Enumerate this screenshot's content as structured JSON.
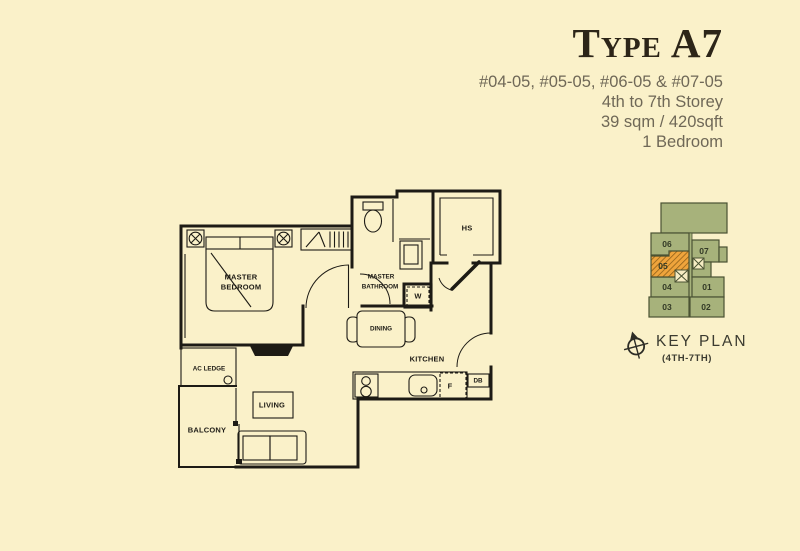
{
  "header": {
    "title": "Type A7",
    "unit_numbers": "#04-05, #05-05, #06-05 & #07-05",
    "storey": "4th to 7th Storey",
    "area": "39 sqm / 420sqft",
    "bedroom": "1 Bedroom"
  },
  "floorplan": {
    "rooms": {
      "master_bedroom_line1": "MASTER",
      "master_bedroom_line2": "BEDROOM",
      "master_bathroom_line1": "MASTER",
      "master_bathroom_line2": "BATHROOM",
      "dining": "DINING",
      "kitchen": "KITCHEN",
      "living": "LIVING",
      "balcony": "BALCONY",
      "ac_ledge": "AC LEDGE",
      "household_shelter": "HS",
      "washer": "W",
      "fridge": "F",
      "db": "DB"
    }
  },
  "keyplan": {
    "label": "KEY PLAN",
    "sublabel": "(4TH-7TH)",
    "highlighted_unit": "05",
    "units": {
      "u06": "06",
      "u05": "05",
      "u04": "04",
      "u03": "03",
      "u07": "07",
      "u01": "01",
      "u02": "02"
    }
  },
  "colors": {
    "background": "#faf1c9",
    "plan_line": "#1d1b15",
    "keyplan_building": "#a7b27b",
    "keyplan_outline": "#4a5233",
    "highlight_orange": "#efa43c",
    "hatch_stroke": "#8a5c17",
    "title_text": "#2c2518",
    "subtitle_text": "#6f6857"
  }
}
